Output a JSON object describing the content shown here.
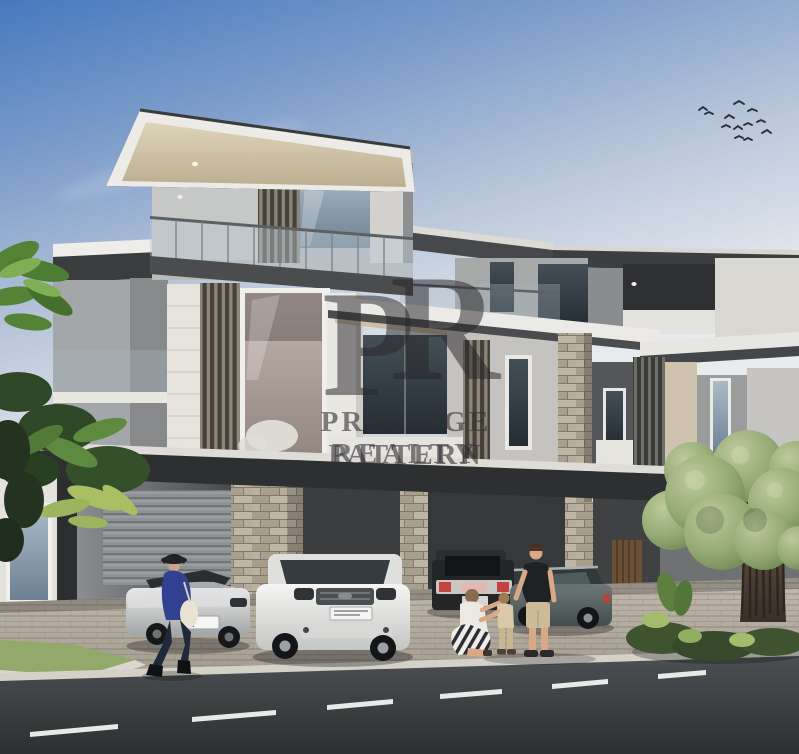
{
  "watermark": {
    "monogram_p": "P",
    "monogram_r": "R",
    "line1": "PRESTIGE PATTERN",
    "line2": "REALTY",
    "color": "#2a282d",
    "opacity": 0.55
  },
  "palette": {
    "sky_top": "#4679bd",
    "sky_horizon": "#e8ebef",
    "roof_dark": "#2f3032",
    "soffit_cream": "#d6cbae",
    "wall_light": "#dcdad5",
    "wall_gray": "#9a9c9b",
    "glass_blue": "#7e93a6",
    "glass_warm": "#b1a39e",
    "louver_dark": "#46413a",
    "stone": "#b2a998",
    "pavement": "#b4ada1",
    "road": "#3a3e40",
    "grass": "#93a86b",
    "tree_green": "#8ea372",
    "trunk_brown": "#4a3f36",
    "car_white": "#eeefed",
    "car_silver": "#c7c9c8",
    "truck_black": "#24262a",
    "wagon_teal": "#57605f",
    "figure_blue": "#32418f",
    "shorts_khaki": "#cbbb97",
    "taillight_red": "#c2433f"
  }
}
